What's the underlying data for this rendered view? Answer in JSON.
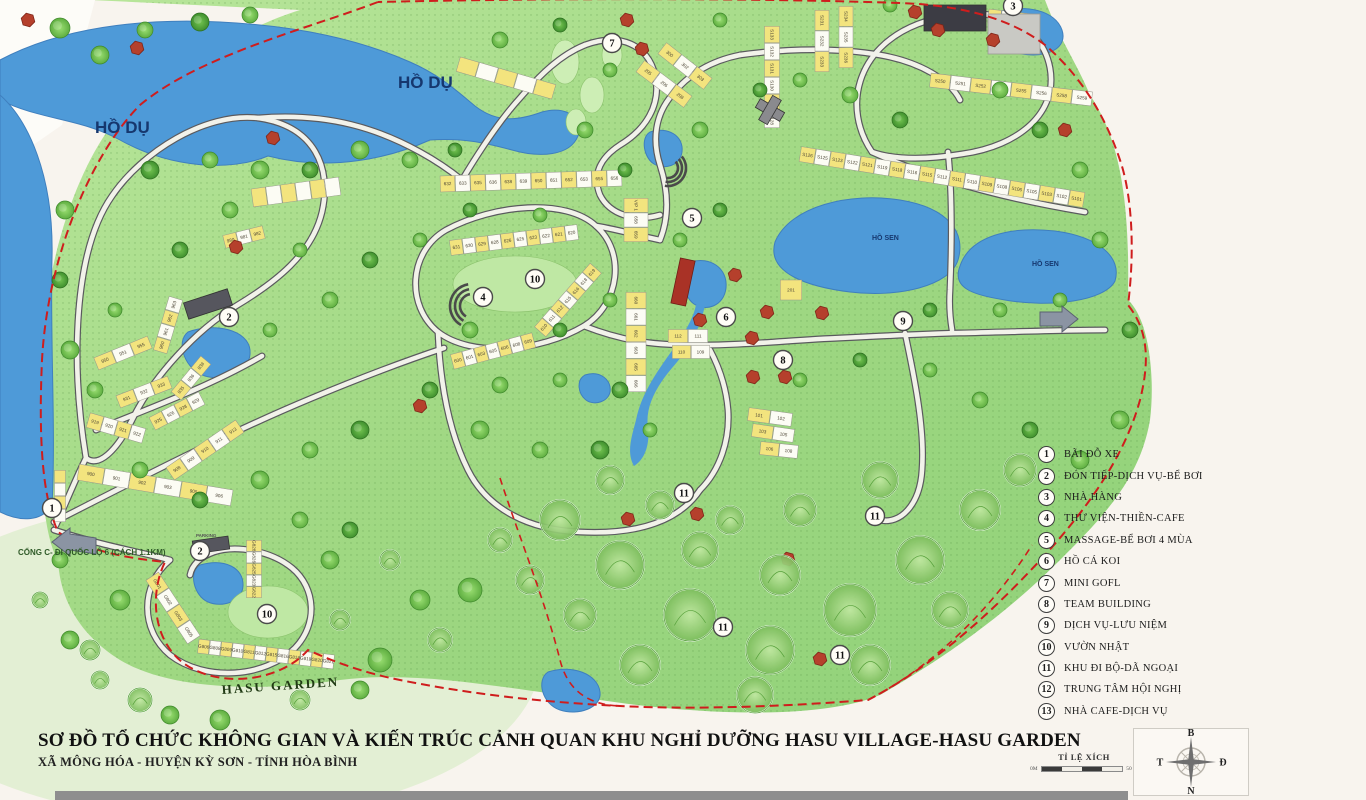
{
  "page_title": "SƠ ĐỒ TỔ CHỨC KHÔNG GIAN HASU VILLAGE-HASU GARDEN",
  "footer": {
    "title": "SƠ ĐỒ TỔ CHỨC KHÔNG GIAN VÀ KIẾN TRÚC CẢNH QUAN KHU NGHỈ DƯỠNG HASU VILLAGE-HASU GARDEN",
    "subtitle": "XÃ MÔNG HÓA - HUYỆN KỲ SƠN - TỈNH HÒA BÌNH"
  },
  "legend": {
    "items": [
      {
        "num": "1",
        "label": "BÃI ĐỖ XE"
      },
      {
        "num": "2",
        "label": "ĐÓN TIẾP-DỊCH VỤ-BỂ BƠI"
      },
      {
        "num": "3",
        "label": "NHÀ HÀNG"
      },
      {
        "num": "4",
        "label": "THƯ VIỆN-THIỀN-CAFE"
      },
      {
        "num": "5",
        "label": "MASSAGE-BỂ BƠI 4 MÙA"
      },
      {
        "num": "6",
        "label": "HỒ CÁ KOI"
      },
      {
        "num": "7",
        "label": "MINI GOFL"
      },
      {
        "num": "8",
        "label": "TEAM BUILDING"
      },
      {
        "num": "9",
        "label": "DỊCH VỤ-LƯU NIỆM"
      },
      {
        "num": "10",
        "label": "VƯỜN NHẬT"
      },
      {
        "num": "11",
        "label": "KHU ĐI BỘ-DÃ NGOẠI"
      },
      {
        "num": "12",
        "label": "TRUNG TÂM HỘI NGHỊ"
      },
      {
        "num": "13",
        "label": "NHÀ CAFE-DỊCH VỤ"
      }
    ]
  },
  "scale": {
    "label": "TỈ LỆ XÍCH",
    "min": "0M",
    "max": "50 M"
  },
  "compass": {
    "north": "B",
    "south": "N",
    "west": "T",
    "east": "Đ"
  },
  "map": {
    "colors": {
      "lake": "#4e9ad8",
      "boundary": "#cf1d1d",
      "land": "#a3da85",
      "road": "#f2f2ea",
      "lot_yellow": "#f3e47e",
      "hut_red": "#b5402c",
      "label_navy": "#16376e"
    },
    "labels": [
      {
        "text": "HỒ DỤ",
        "x": 95,
        "y": 133,
        "fs": 17,
        "type": "lake"
      },
      {
        "text": "HỒ DỤ",
        "x": 398,
        "y": 88,
        "fs": 17,
        "type": "lake"
      },
      {
        "text": "HỒ SEN",
        "x": 872,
        "y": 240,
        "fs": 7,
        "type": "lake-small"
      },
      {
        "text": "HỒ SEN",
        "x": 1032,
        "y": 266,
        "fs": 7,
        "type": "lake-small"
      },
      {
        "text": "HASU GARDEN",
        "x": 222,
        "y": 694,
        "fs": 13,
        "type": "garden"
      },
      {
        "text": "PARKING",
        "x": 196,
        "y": 537,
        "fs": 4.5,
        "type": "tiny"
      },
      {
        "text": "CỔNG C- ĐI QUỐC LỘ 6 (CÁCH 1.1KM)",
        "x": 18,
        "y": 555,
        "fs": 8,
        "type": "gate"
      }
    ],
    "markers": [
      {
        "n": "1",
        "x": 52,
        "y": 508
      },
      {
        "n": "2",
        "x": 229,
        "y": 317
      },
      {
        "n": "2",
        "x": 200,
        "y": 551
      },
      {
        "n": "3",
        "x": 1013,
        "y": 6
      },
      {
        "n": "4",
        "x": 483,
        "y": 297
      },
      {
        "n": "5",
        "x": 692,
        "y": 218
      },
      {
        "n": "6",
        "x": 726,
        "y": 317
      },
      {
        "n": "7",
        "x": 612,
        "y": 43
      },
      {
        "n": "8",
        "x": 783,
        "y": 360
      },
      {
        "n": "9",
        "x": 903,
        "y": 321
      },
      {
        "n": "10",
        "x": 535,
        "y": 279
      },
      {
        "n": "10",
        "x": 267,
        "y": 614
      },
      {
        "n": "11",
        "x": 684,
        "y": 493
      },
      {
        "n": "11",
        "x": 875,
        "y": 516
      },
      {
        "n": "11",
        "x": 723,
        "y": 627
      },
      {
        "n": "11",
        "x": 840,
        "y": 655
      }
    ],
    "lots": {
      "w1": [
        "900",
        "901",
        "902",
        "903",
        "905",
        "906"
      ],
      "w2": [
        "908",
        "909",
        "910",
        "911",
        "913"
      ],
      "w3": [
        "919",
        "920",
        "921",
        "922"
      ],
      "w4": [
        "925",
        "926",
        "928",
        "929"
      ],
      "w5": [
        "931",
        "932",
        "933"
      ],
      "w6": [
        "935",
        "936",
        "938"
      ],
      "w7": [
        "950",
        "951",
        "955"
      ],
      "w8": [
        "960",
        "961",
        "962",
        "963"
      ],
      "w9": [
        "980",
        "981",
        "982"
      ],
      "w10": [
        "",
        "",
        "",
        "",
        "",
        ""
      ],
      "pk1": [
        "",
        "",
        "",
        ""
      ],
      "c1": [
        "632",
        "633",
        "635",
        "636",
        "638",
        "639",
        "650",
        "651",
        "652",
        "653",
        "655",
        "656"
      ],
      "c2": [
        "VIP 1",
        "658",
        "659"
      ],
      "c3": [
        "631",
        "630",
        "629",
        "628",
        "626",
        "625",
        "623",
        "622",
        "621",
        "620"
      ],
      "c4": [
        "660",
        "661",
        "662",
        "663",
        "665",
        "666"
      ],
      "c5": [
        "600",
        "601",
        "603",
        "605",
        "606",
        "608",
        "609"
      ],
      "c6": [
        "610",
        "611",
        "612",
        "615",
        "616",
        "618",
        "619"
      ],
      "b1a": [
        "112",
        "111"
      ],
      "b1b": [
        "110",
        "109"
      ],
      "b2a": [
        "101",
        "102"
      ],
      "b2b": [
        "103",
        "105"
      ],
      "b2c": [
        "106",
        "108"
      ],
      "b3": [
        "201"
      ],
      "g1": [
        "205",
        "206",
        "208"
      ],
      "g2": [
        "300",
        "302",
        "303"
      ],
      "t1": [
        "",
        "",
        "",
        "",
        ""
      ],
      "n1": [
        "S133",
        "S132",
        "S131",
        "S130",
        "S129",
        "S128"
      ],
      "n2": [
        "S231",
        "S232",
        "S233"
      ],
      "n3": [
        "S234",
        "S235",
        "S236"
      ],
      "n5": [
        "S126",
        "S125",
        "S123",
        "S122",
        "S121",
        "S119",
        "S118",
        "S116",
        "S115",
        "S112",
        "S111",
        "S110",
        "S109",
        "S108",
        "S106",
        "S105",
        "S103",
        "S102",
        "S101"
      ],
      "n6": [
        "S250",
        "S251",
        "S252",
        "S253",
        "S255",
        "S256",
        "S258",
        "S259"
      ],
      "h1": [
        "G801",
        "G802",
        "G803",
        "G805"
      ],
      "h2": [
        "G806",
        "G808",
        "G809",
        "G810",
        "G811",
        "G812",
        "G815",
        "G816",
        "G818",
        "G819",
        "G820",
        "G821"
      ],
      "h4": [
        "G828",
        "G826",
        "G825",
        "G823",
        "G822"
      ],
      "pk2": [
        "",
        "",
        "",
        ""
      ]
    }
  }
}
